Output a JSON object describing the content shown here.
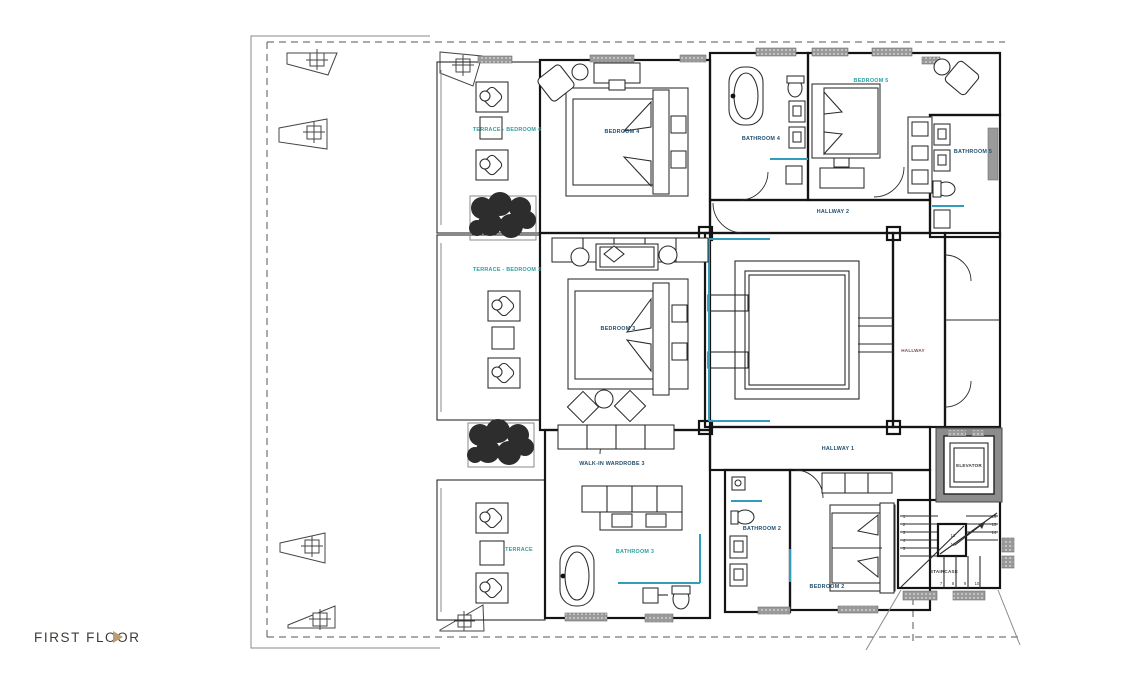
{
  "footer": {
    "label": "FIRST FLOOR"
  },
  "icons": {
    "floor_nav_arrow": "right-triangle"
  },
  "rooms": {
    "terrace_bedroom_4": "TERRACE - BEDROOM 4",
    "bedroom_4": "BEDROOM 4",
    "bathroom_4": "BATHROOM 4",
    "bedroom_5": "BEDROOM 5",
    "bathroom_5": "BATHROOM 5",
    "hallway_2": "HALLWAY 2",
    "terrace_bedroom_3": "TERRACE - BEDROOM 3",
    "bedroom_3": "BEDROOM 3",
    "hallway": "HALLWAY",
    "walk_in_wardrobe_3": "WALK-IN WARDROBE 3",
    "hallway_1": "HALLWAY 1",
    "elevator": "ELEVATOR",
    "bathroom_2": "BATHROOM 2",
    "bathroom_3": "BATHROOM 3",
    "terrace": "TERRACE",
    "bedroom_2": "BEDROOM 2",
    "staircase": "STAIRCASE"
  },
  "stairs": {
    "left": [
      "1",
      "2",
      "3",
      "4",
      "5"
    ],
    "bottom": [
      "7",
      "8",
      "9",
      "10"
    ],
    "right": [
      "16",
      "15",
      "14"
    ],
    "mid": [
      "13",
      "12"
    ]
  },
  "colors": {
    "label_teal": "#2f9e9e",
    "label_navy": "#1f4e6e",
    "label_maroon": "#7a4a4a",
    "accent_teal_glazing": "#2f9dbb",
    "gold_arrow": "#b99e72",
    "wall": "#141414",
    "vent_gray": "#9a9a9a"
  }
}
